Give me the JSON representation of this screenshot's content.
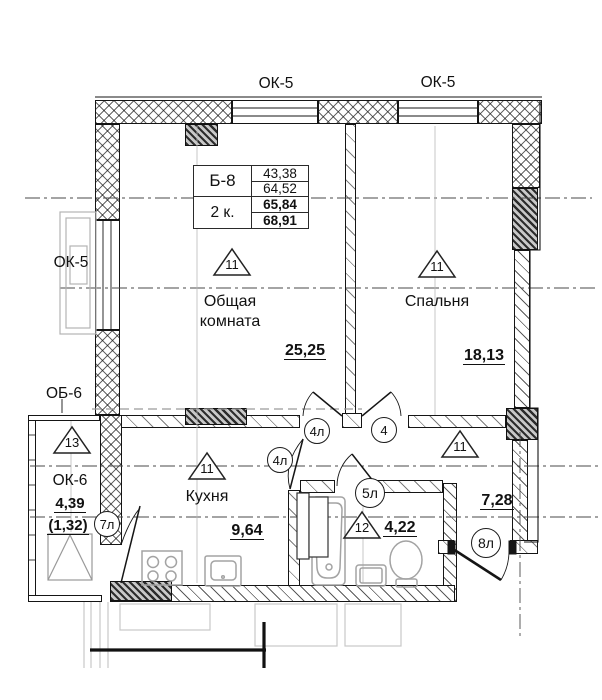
{
  "table": {
    "flat_type": "Б-8",
    "rooms_count": "2 к.",
    "living_area_upper": "43,38",
    "living_area_lower": "64,52",
    "total_area": "65,84",
    "total_area_with_balcony": "68,91"
  },
  "window_labels": {
    "top_left": "ОК-5",
    "top_right": "ОК-5",
    "left": "ОК-5",
    "loggia_window": "ОК-6",
    "balcony_door": "ОБ-6"
  },
  "rooms": {
    "living": {
      "marker": "11",
      "name_line1": "Общая",
      "name_line2": "комната",
      "area": "25,25"
    },
    "bedroom": {
      "marker": "11",
      "name": "Спальня",
      "area": "18,13"
    },
    "kitchen": {
      "marker": "11",
      "name": "Кухня",
      "area": "9,64"
    },
    "bathroom": {
      "marker": "12",
      "area": "4,22"
    },
    "hallway": {
      "marker": "11",
      "area": "7,28"
    },
    "loggia": {
      "marker": "13",
      "area": "4,39",
      "area_coefficient": "(1,32)"
    }
  },
  "door_tags": {
    "living_door": "4л",
    "bedroom_door": "4",
    "kitchen_door": "4л",
    "bathroom_door": "5л",
    "loggia_door": "7л",
    "entrance_door": "8л"
  }
}
